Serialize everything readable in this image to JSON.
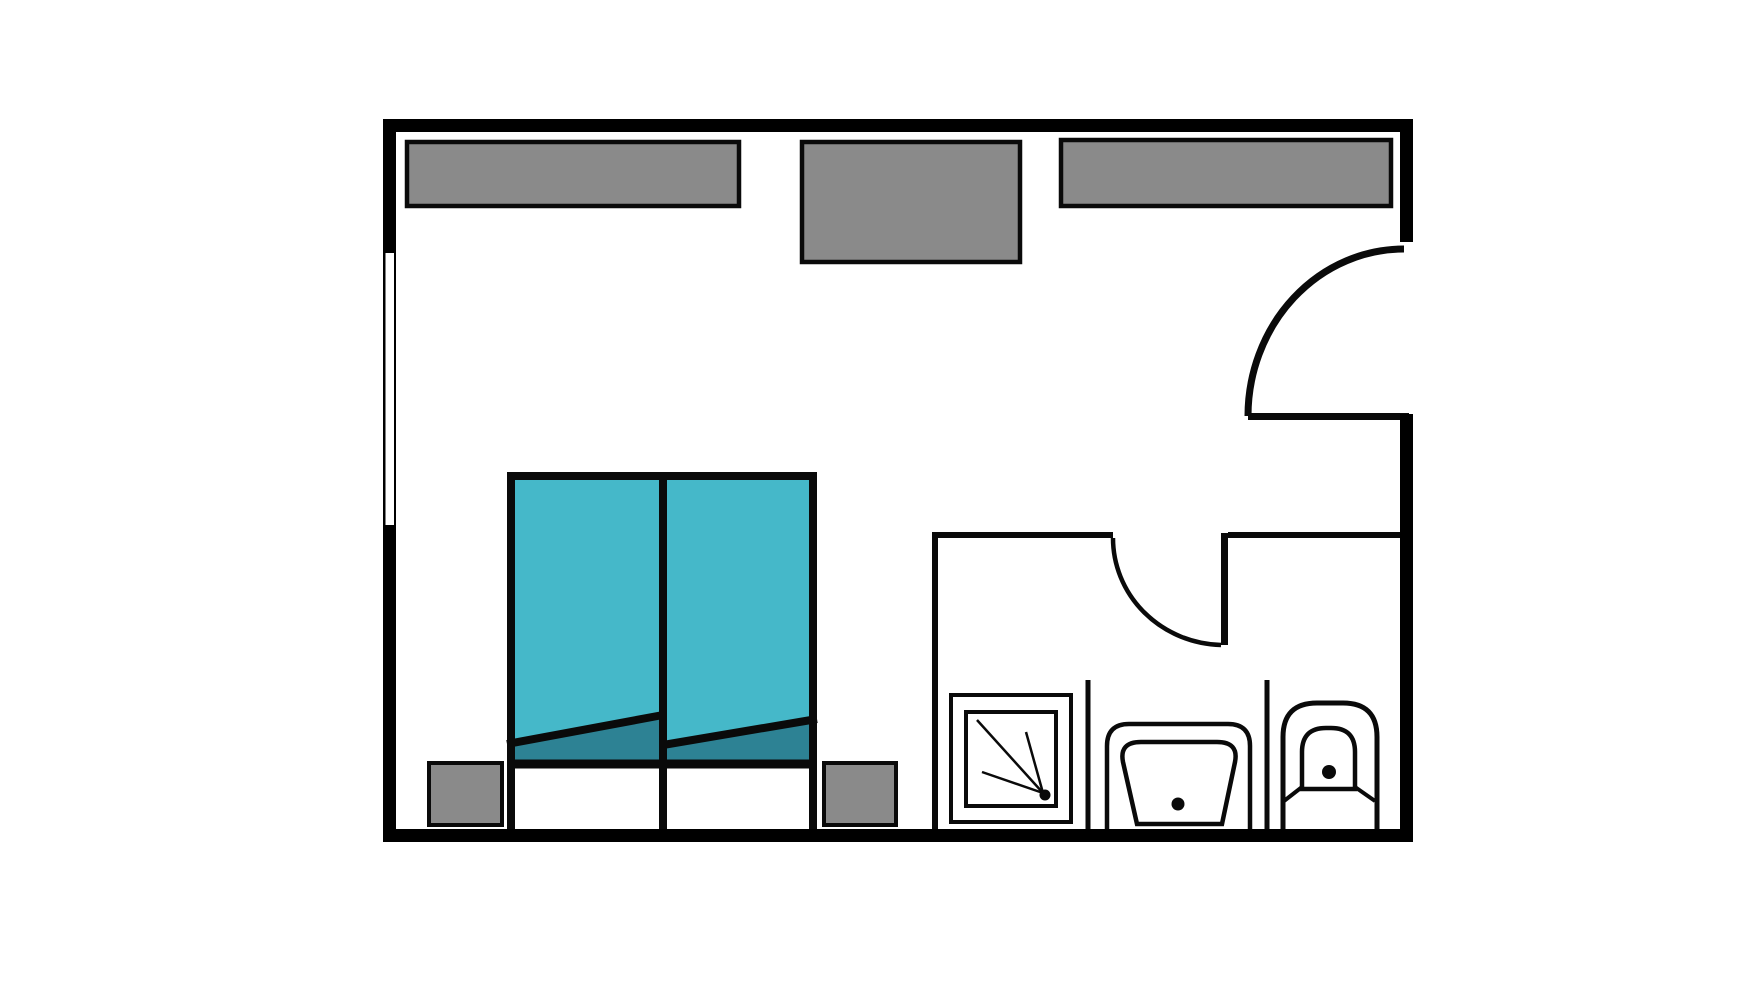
{
  "diagram": {
    "type": "floor-plan",
    "subject": "hotel-guest-room-with-ensuite-bathroom",
    "text_labels": []
  },
  "colors": {
    "floor": "#ffffff",
    "wall": "#000000",
    "outline": "#0a0a0a",
    "furniture_fill": "#8a8a8a",
    "bed_spread": "#45b8c9",
    "bed_spread_dark": "#2d8294",
    "fixture_fill": "#ffffff"
  },
  "elements": {
    "exterior": [
      "outer-walls",
      "window-in-left-wall",
      "entry-door-opening-right-wall",
      "entry-door-leaf",
      "entry-door-swing-arc"
    ],
    "bedroom_furniture": [
      "wide-cabinet-top-left",
      "deep-cabinet-top-middle",
      "wide-cabinet-top-right",
      "twin-bed-left",
      "twin-bed-right",
      "nightstand-left",
      "nightstand-right"
    ],
    "bathroom": [
      "bathroom-partition-walls",
      "bathroom-door-leaf",
      "bathroom-door-swing-arc",
      "shower-stall-with-spray-symbol",
      "toilet",
      "bidet"
    ]
  }
}
